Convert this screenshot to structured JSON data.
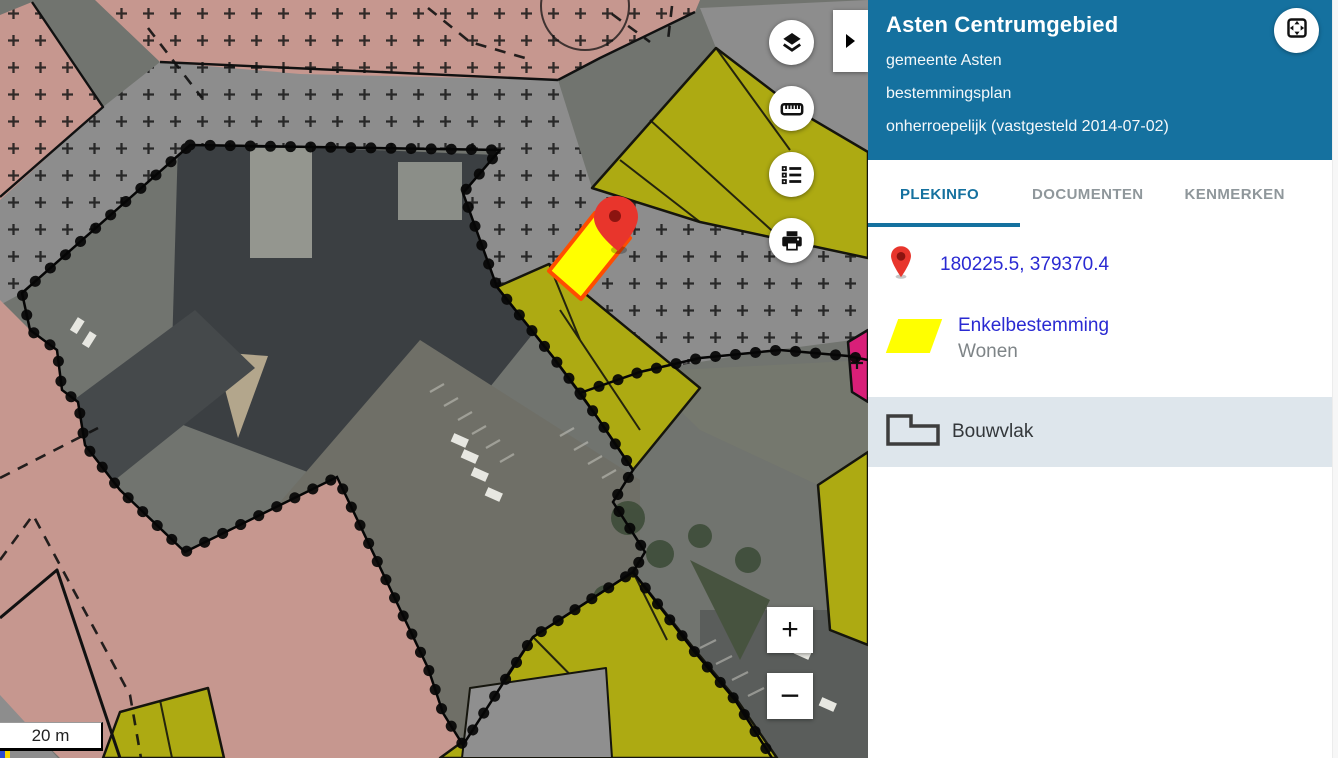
{
  "header": {
    "title": "Asten Centrumgebied",
    "subtitle_lines": [
      "gemeente Asten",
      "bestemmingsplan",
      "onherroepelijk (vastgesteld 2014-07-02)"
    ]
  },
  "tabs": [
    {
      "label": "PLEKINFO",
      "active": true
    },
    {
      "label": "DOCUMENTEN",
      "active": false
    },
    {
      "label": "KENMERKEN",
      "active": false
    }
  ],
  "plekinfo": {
    "coordinates": "180225.5, 379370.4",
    "bestemming": {
      "category": "Enkelbestemming",
      "value": "Wonen"
    },
    "bouwvlak_label": "Bouwvlak"
  },
  "map": {
    "scale_label": "20 m",
    "zoom_in_label": "+",
    "zoom_out_label": "−",
    "controls": [
      "layers",
      "measure",
      "legend",
      "print"
    ],
    "selected_parcel": {
      "fill": "#ffff00",
      "outline": "#ff4d00"
    },
    "marker_color": "#e8352c"
  },
  "colors": {
    "header_bg": "#15719f",
    "link_blue": "#2a2ad2",
    "tab_active": "#15719f",
    "tab_inactive": "#8f979b",
    "row_highlight_bg": "#dee6ec",
    "zone_pink": "#c6978f",
    "zone_gray": "#8d8d8d",
    "zone_olive": "#adaa12",
    "zone_magenta": "#d81f78"
  }
}
